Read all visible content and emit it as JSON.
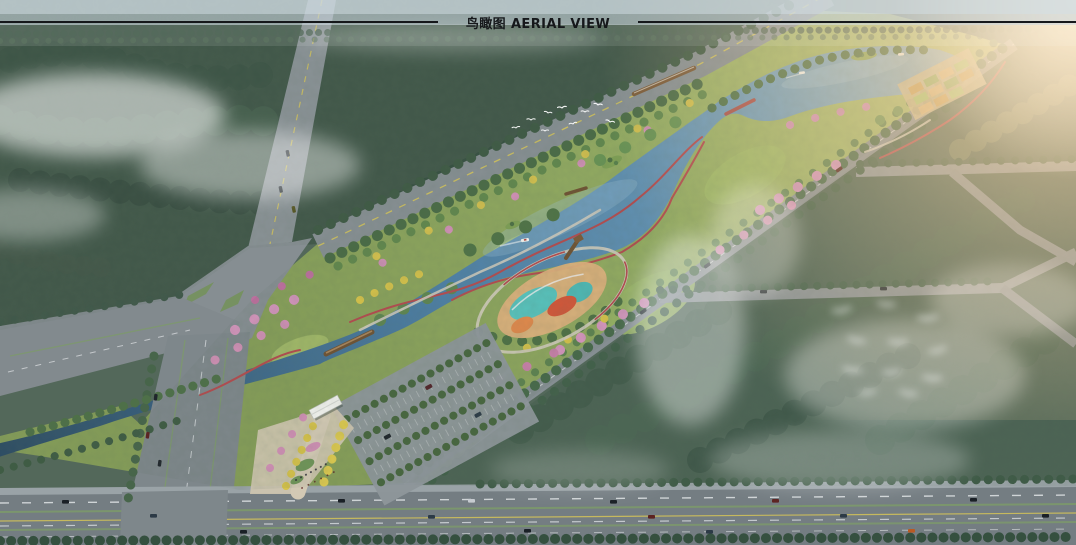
{
  "page": {
    "title": "鸟瞰图 AERIAL VIEW",
    "title_cn": "鸟瞰图",
    "title_en": "AERIAL VIEW"
  },
  "palette": {
    "title_ink": "#16181b",
    "rule_line": "#16181b",
    "haze_sky": "#c9d6de",
    "forest_dark": "#3c5244",
    "forest_mid": "#4a6152",
    "park_green": "#8fa95e",
    "lawn_light": "#a8bf6e",
    "water_dark": "#2e4d63",
    "water_main": "#4e80a6",
    "water_light": "#8fb4c6",
    "road_gray": "#878f93",
    "road_dark": "#747d82",
    "sidewalk": "#9aa3a7",
    "lane_yellow": "#d5c45c",
    "median_green": "#7d9a6a",
    "path_red": "#b44b4f",
    "path_gray": "#cdc9bc",
    "tree_yellow": "#d6c24a",
    "tree_pink": "#d394bb",
    "playground_teal": "#58c2bc",
    "playground_red": "#d2573a",
    "sand_tan": "#dcb07c",
    "plaza_tan": "#cfc5b0",
    "bridge_brown": "#7c5a38",
    "glow_warm": "#ffd9a8",
    "bird_white": "#ffffff"
  }
}
